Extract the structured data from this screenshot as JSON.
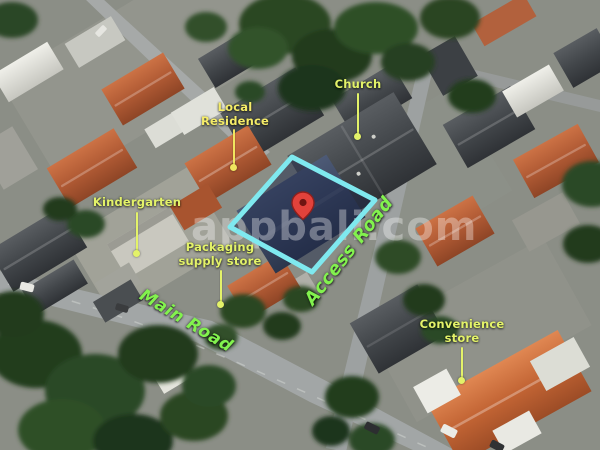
{
  "watermark": {
    "text": "appbali.com"
  },
  "plot": {
    "outline_color": "#7fe9ef",
    "fill_color": "#1d2848",
    "pin_color": "#e2423b"
  },
  "labels": {
    "local_residence": {
      "line1": "Local",
      "line2": "Residence",
      "color": "#f5ec68"
    },
    "church": {
      "text": "Church",
      "color": "#e3f269"
    },
    "kindergarten": {
      "text": "Kindergarten",
      "color": "#e3f269"
    },
    "packaging_store": {
      "line1": "Packaging",
      "line2": "supply store",
      "color": "#e3f269"
    },
    "convenience_store": {
      "line1": "Convenience",
      "line2": "store",
      "color": "#e3f269"
    },
    "main_road": {
      "text": "Main Road",
      "color": "#82f24e"
    },
    "access_road": {
      "text": "Access Road",
      "color": "#82f24e"
    }
  }
}
